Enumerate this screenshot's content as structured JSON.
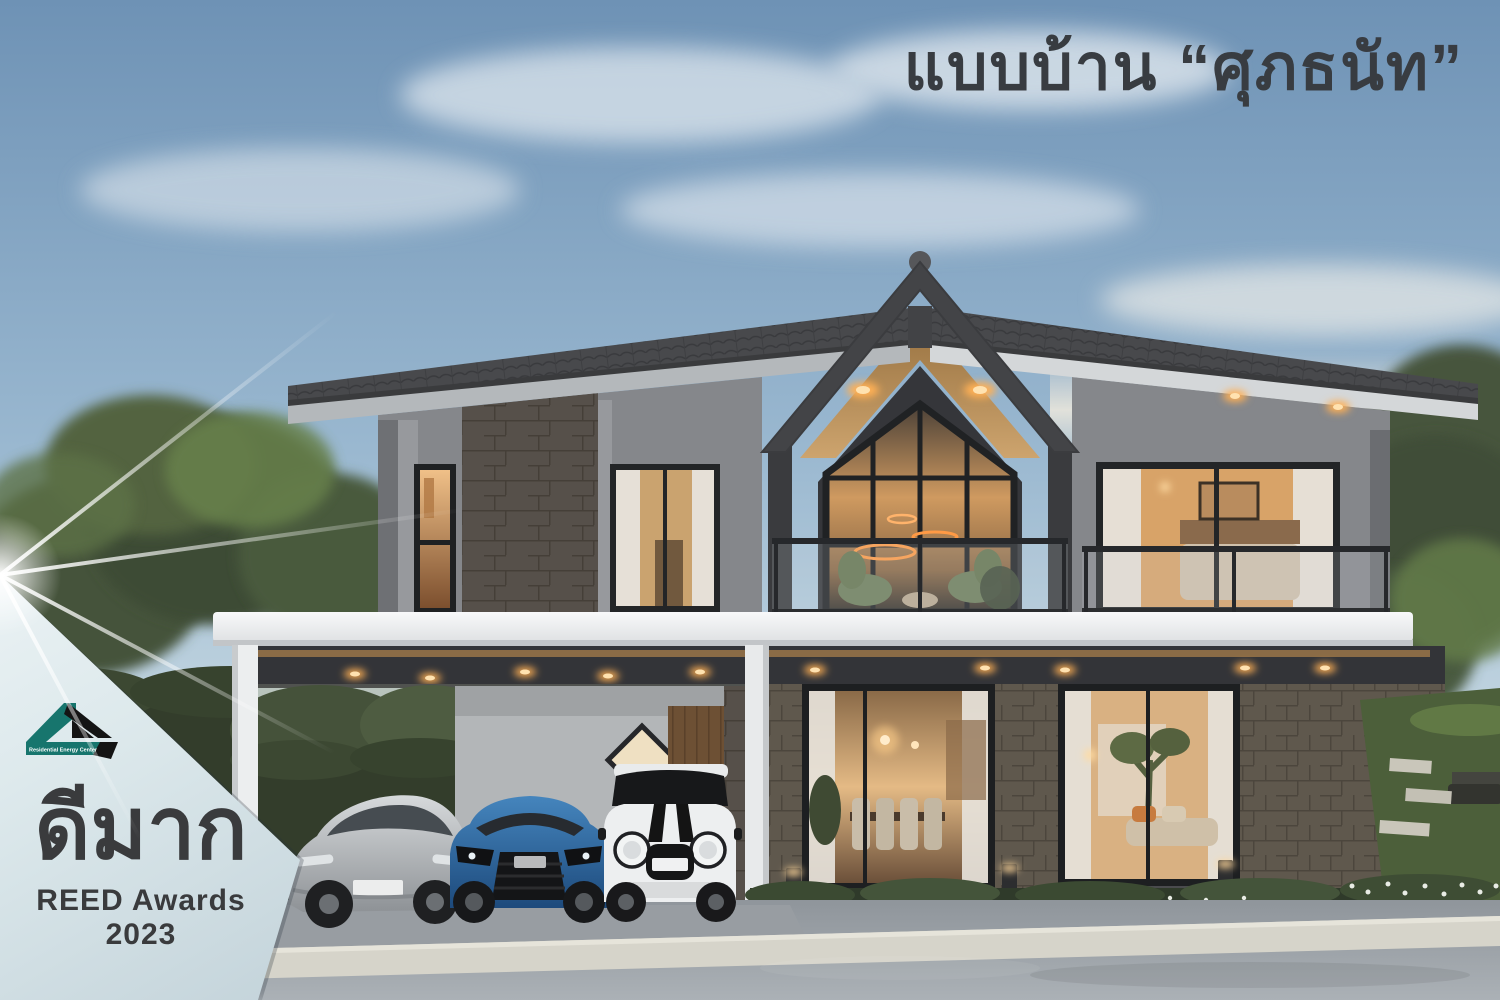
{
  "title": {
    "text": "แบบบ้าน “ศุภธนัท”"
  },
  "badge": {
    "headline": "ดีมาก",
    "subline": "REED Awards 2023",
    "logo_caption": "Residential Energy Center"
  },
  "palette": {
    "sky_top": "#6e92b5",
    "sky_mid": "#a9c3d6",
    "horizon_haze": "#efe7da",
    "title_text": "#383c41",
    "badge_bg_light": "#ecf3f5",
    "badge_bg_dark": "#c3d3da",
    "badge_text": "#3a3b3d",
    "logo_teal": "#17756d",
    "logo_black": "#141414",
    "roof_dark": "#46474a",
    "wall_grey": "#8a8c90",
    "stone_panel": "#5d554a",
    "wood_soffit": "#b78e59",
    "slab_white": "#f3f4f5",
    "warm_light": "#ffb763",
    "hedge_green": "#37422f",
    "grass_green": "#55683f",
    "car_silver": "#b4b8bb",
    "car_blue": "#2d66a0",
    "car_white": "#edeff0",
    "road_grey": "#9aa1a7",
    "kerb_stone": "#d3d1c8"
  }
}
